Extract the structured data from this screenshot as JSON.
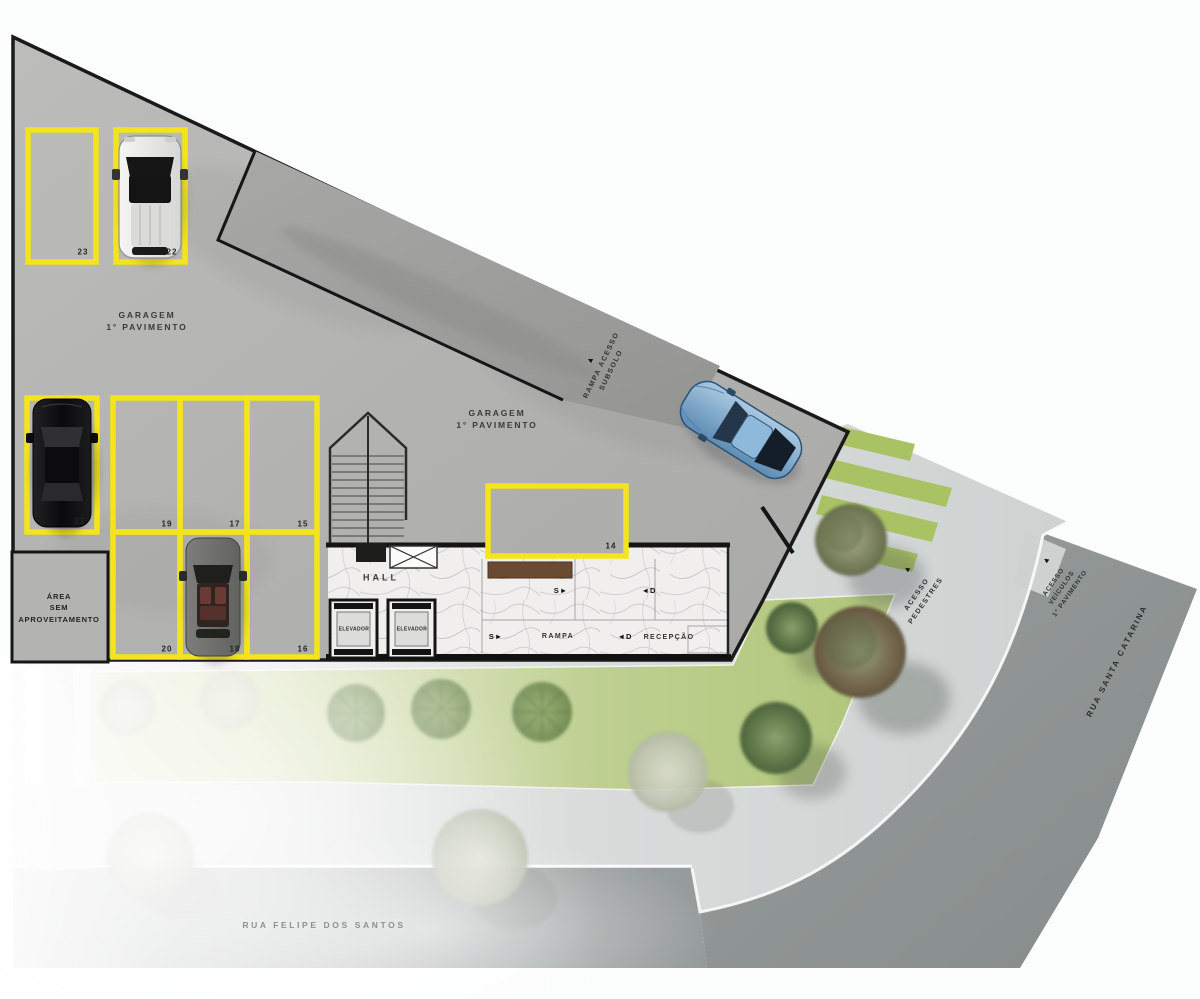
{
  "plan": {
    "garage_label": {
      "line1": "GARAGEM",
      "line2": "1° PAVIMENTO"
    },
    "ramp_access_label": {
      "line1": "RAMPA ACESSO",
      "line2": "SUBSOLO"
    },
    "unused_area_label": {
      "line1": "ÁREA",
      "line2": "SEM",
      "line3": "APROVEITAMENTO"
    },
    "hall_label": "HALL",
    "elevator_label": "ELEVADOR",
    "interior_ramp_label": "RAMPA",
    "reception_label": "RECEPÇÃO",
    "direction_markers": {
      "up": "S",
      "down": "D"
    },
    "pedestrian_access_label": {
      "line1": "ACESSO",
      "line2": "PEDESTRES"
    },
    "vehicle_access_label": {
      "line1": "ACESSO",
      "line2": "VEÍCULOS",
      "line3": "1° PAVIMENTO"
    },
    "streets": {
      "right": "RUA SANTA CATARINA",
      "bottom": "RUA FELIPE DOS SANTOS"
    }
  },
  "parking": {
    "spots": [
      {
        "number": "23",
        "occupied": false
      },
      {
        "number": "22",
        "occupied": true,
        "car": "white-suv"
      },
      {
        "number": "21",
        "occupied": true,
        "car": "black-sedan"
      },
      {
        "number": "19",
        "occupied": false
      },
      {
        "number": "17",
        "occupied": false
      },
      {
        "number": "15",
        "occupied": false
      },
      {
        "number": "20",
        "occupied": false
      },
      {
        "number": "18",
        "occupied": true,
        "car": "gray-car"
      },
      {
        "number": "16",
        "occupied": false
      },
      {
        "number": "14",
        "occupied": false
      }
    ]
  },
  "cars": [
    {
      "type": "white-suv",
      "location": "spot-22"
    },
    {
      "type": "black-sedan",
      "location": "spot-21"
    },
    {
      "type": "gray-car",
      "location": "spot-18"
    },
    {
      "type": "blue-coupe",
      "location": "driveway"
    }
  ],
  "icons": {
    "triangle_up": "▲",
    "triangle_right": "►",
    "triangle_left": "◄"
  },
  "colors": {
    "parking_outline": "#f3e41d",
    "garage_concrete": "#b7b7b5",
    "ramp": "#9e9e9c",
    "lawn": "#b8cc84",
    "plaza": "#dbdedd",
    "street_dark": "#8f9594",
    "street_light": "#a6acab",
    "marble": "#efefed"
  }
}
